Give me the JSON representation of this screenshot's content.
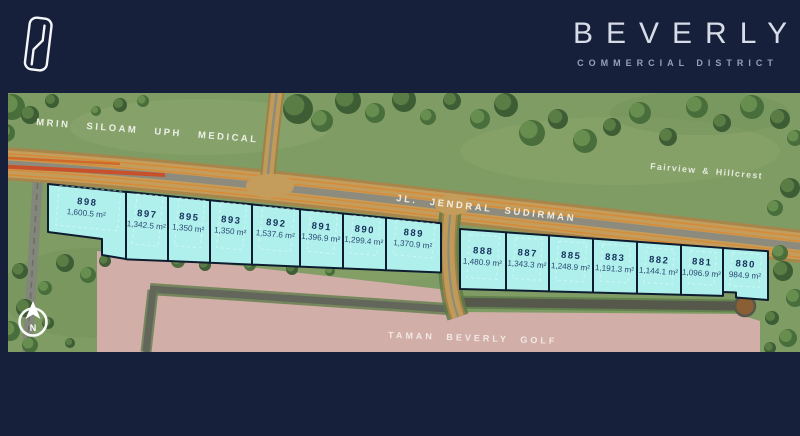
{
  "header": {
    "brand": "BEVERLY",
    "subtitle": "COMMERCIAL DISTRICT"
  },
  "map": {
    "area_labels": {
      "medical": "MRIN SILOAM UPH MEDICAL",
      "fairview": "Fairview & Hillcrest",
      "road": "JL. JENDRAL SUDIRMAN",
      "golf": "TAMAN BEVERLY GOLF",
      "compass": "N"
    },
    "plots": [
      {
        "id": "898",
        "area": "1,600.5 m²"
      },
      {
        "id": "897",
        "area": "1,342.5 m²"
      },
      {
        "id": "895",
        "area": "1,350 m²"
      },
      {
        "id": "893",
        "area": "1,350 m²"
      },
      {
        "id": "892",
        "area": "1,537.6 m²"
      },
      {
        "id": "891",
        "area": "1,396.9 m²"
      },
      {
        "id": "890",
        "area": "1,299.4 m²"
      },
      {
        "id": "889",
        "area": "1,370.9 m²"
      },
      {
        "id": "888",
        "area": "1,480.9 m²"
      },
      {
        "id": "887",
        "area": "1,343.3 m²"
      },
      {
        "id": "885",
        "area": "1,248.9 m²"
      },
      {
        "id": "883",
        "area": "1,191.3 m²"
      },
      {
        "id": "882",
        "area": "1,144.1 m²"
      },
      {
        "id": "881",
        "area": "1,096.9 m²"
      },
      {
        "id": "880",
        "area": "984.9 m²"
      }
    ],
    "colors": {
      "navy": "#16203a",
      "plot_fill": "#b0f0ec",
      "plot_border": "#0e1c30",
      "plot_number_text": "#17315d",
      "plot_area_text": "#2a4a74",
      "road_tan": "#bf9a58",
      "lane_orange": "#d9872f",
      "congestion_red": "#c8502b",
      "golf_zone_pink": "#d2aea8",
      "grass_green": "#7e9c63"
    }
  }
}
